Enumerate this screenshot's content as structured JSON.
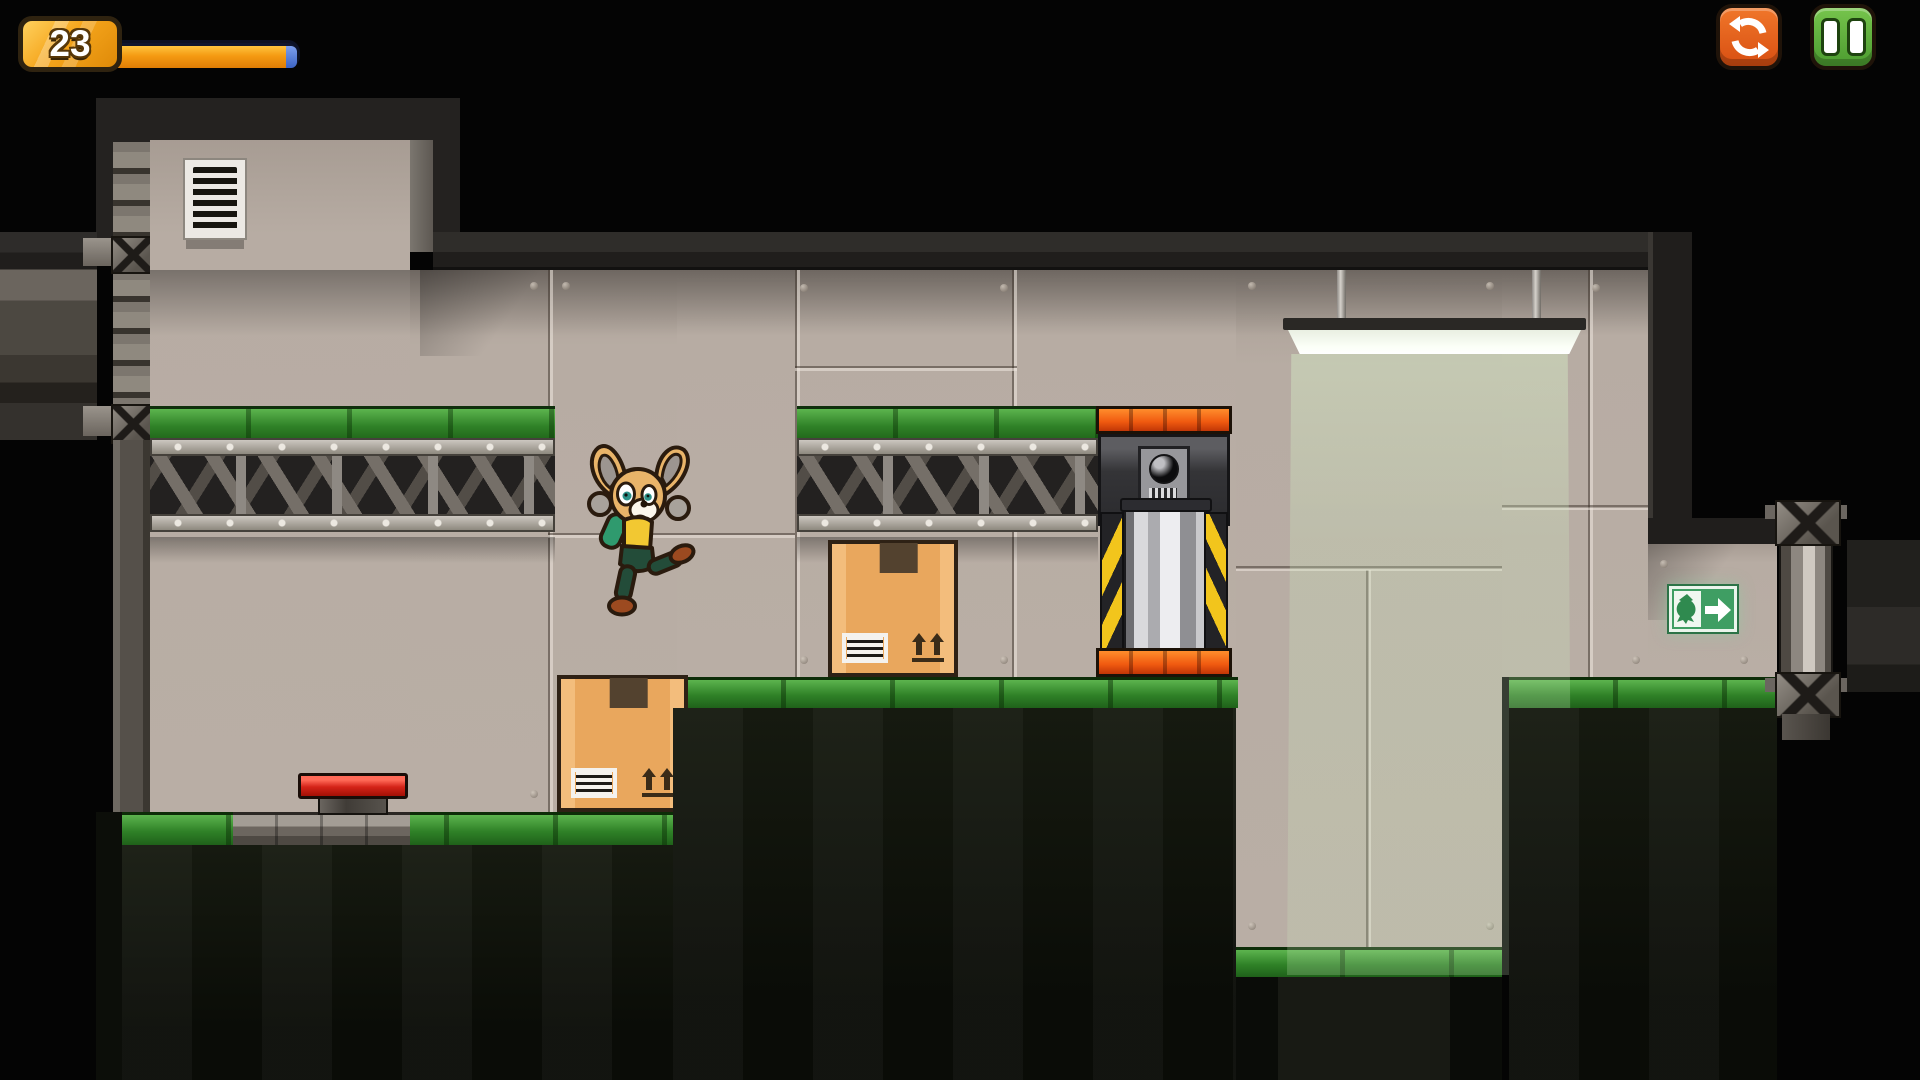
{
  "hud": {
    "counter": "23",
    "progress": {
      "percent_filled": 93,
      "fill_color": "#f59a12",
      "tail_color": "#3b63c4",
      "track_color": "#10162e"
    },
    "badge_color": "#f5a51c"
  },
  "controls": {
    "restart": {
      "label": "Restart",
      "icon": "restart-circular-arrows-icon",
      "color": "#e8641e"
    },
    "pause": {
      "label": "Pause",
      "icon": "pause-icon",
      "color": "#5cb33e"
    }
  },
  "level": {
    "theme": "industrial-warehouse-platformer",
    "palette": {
      "background": "#040404",
      "wall_tan": "#b7aca3",
      "frame_dark": "#242220",
      "platform_green": "#2f8127",
      "hazard_orange": "#f05a10",
      "button_red": "#d42318",
      "exit_green": "#3f9e63",
      "beam_tint": "#cde8be",
      "metal_gray": "#8e897f"
    },
    "objects": {
      "air_vent": "air-vent-grille",
      "girder_platforms": 2,
      "cardboard_boxes": 2,
      "floor_button": "red-floor-button",
      "crusher": "piston-crusher-with-camera-sensor",
      "hanging_light": "fluorescent-hanging-lamp",
      "light_beam": "pale-green-light-shaft",
      "exit_sign": {
        "symbol_left": "fox-pictogram",
        "symbol_right": "right-arrow"
      },
      "exit_door": "metal-door-column",
      "pit": "lowered-pit-with-green-floor"
    },
    "player": {
      "character": "fox",
      "state": "jumping",
      "shirt": "yellow-green",
      "shorts": "dark-green"
    }
  }
}
